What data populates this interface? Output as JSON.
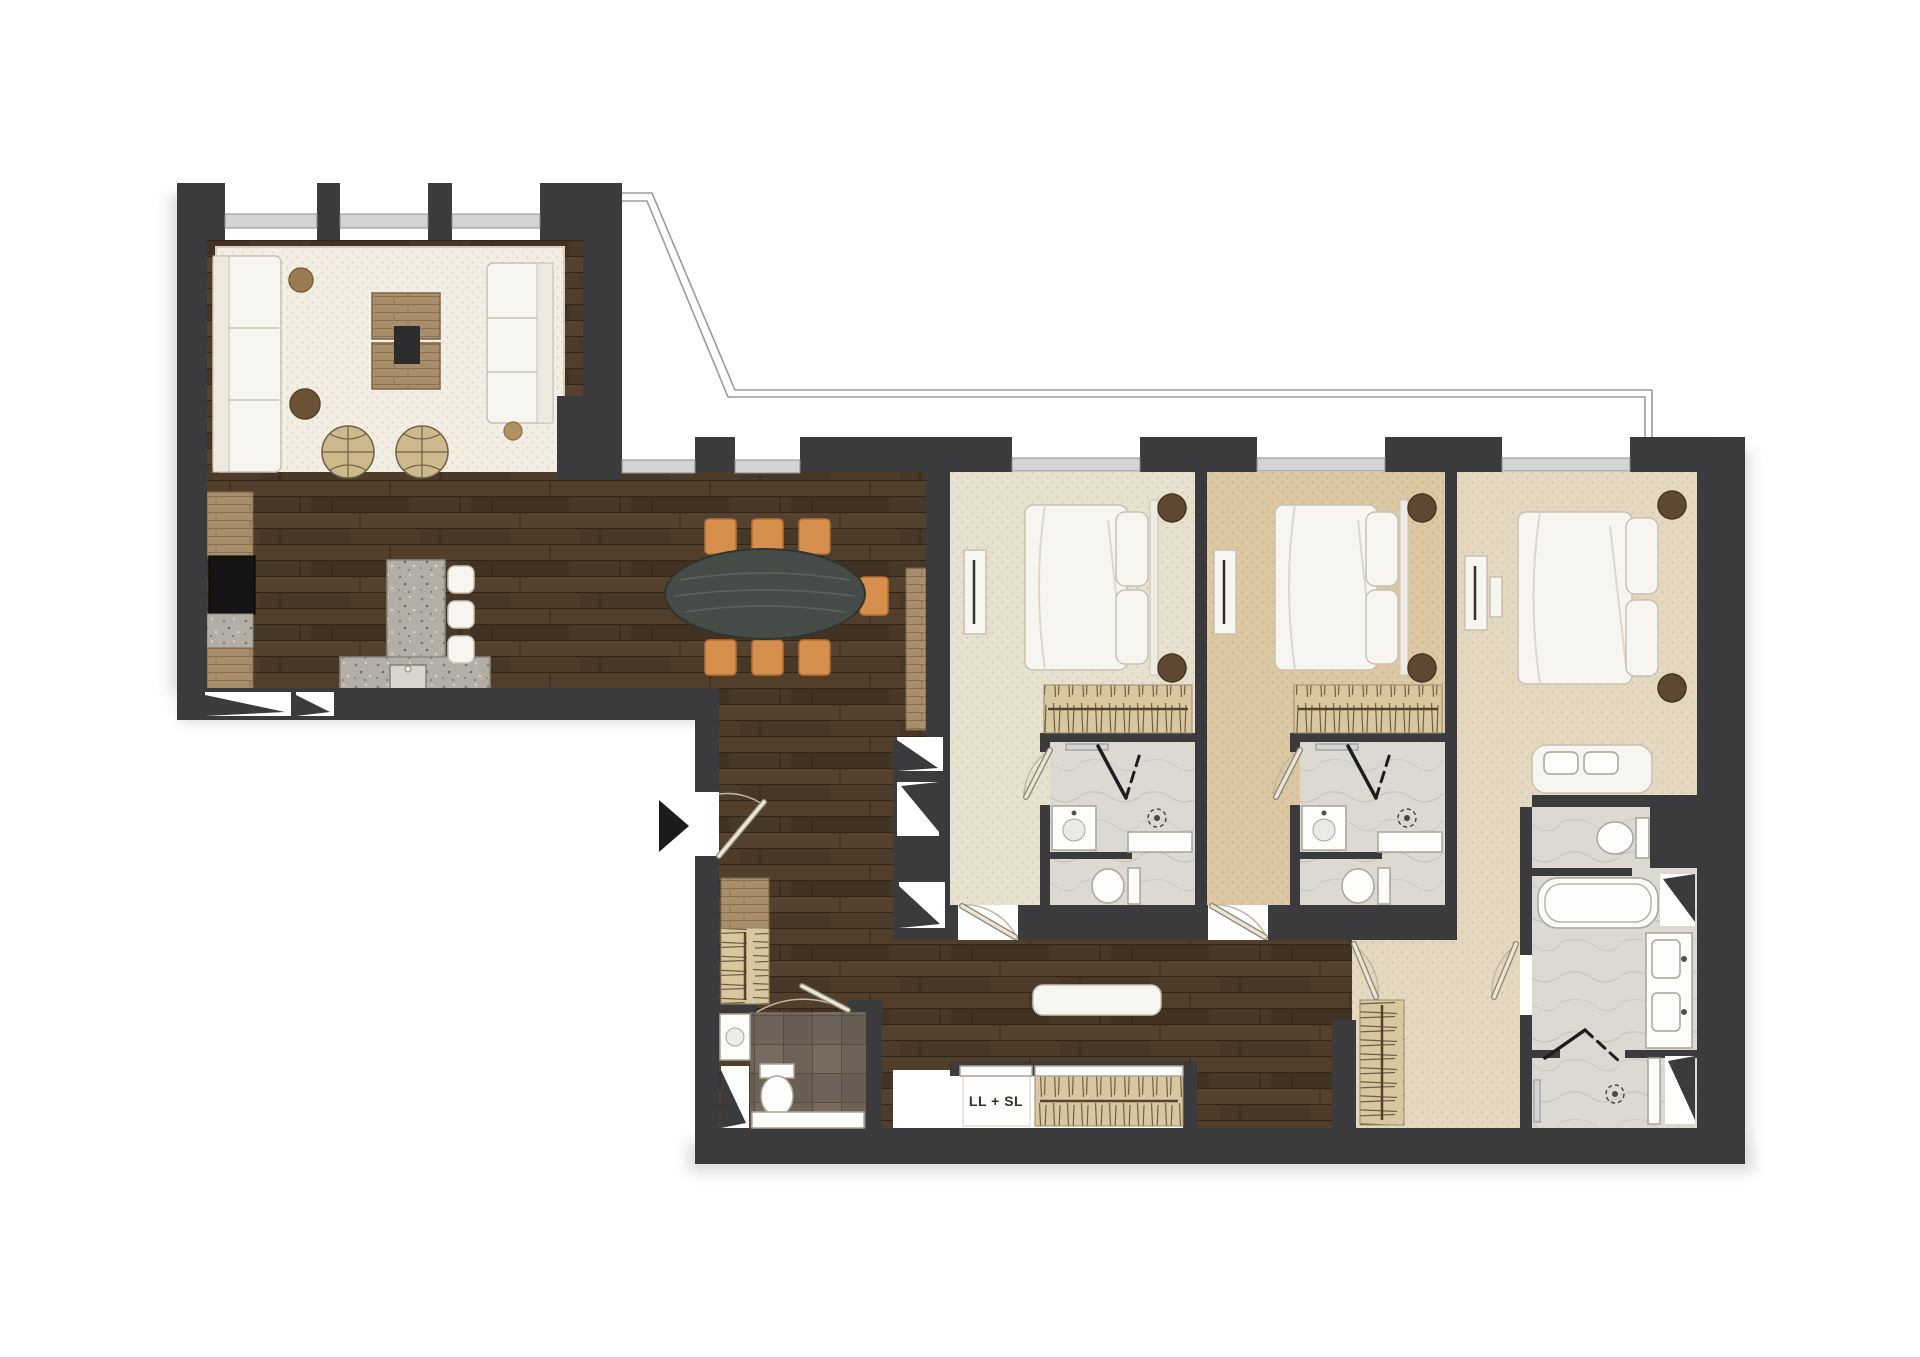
{
  "labels": {
    "laundry": "LL + SL"
  },
  "palette": {
    "wall": "#3b3a3c",
    "wood-base": "#4b3a2a",
    "carpet-cream": "#e9e1d0",
    "carpet-tan": "#dcc8a2",
    "carpet-dressing": "#e4d8c0",
    "rug": "#f2eee3",
    "marble": "#dcd9d3",
    "granite": "#b3afa6",
    "tile-dark": "#6e6359",
    "cabinet-wood": "#a98e6b",
    "closet-stripe": "#d9c7a0",
    "chair-orange": "#d78f4e",
    "table-dark": "#454c48",
    "white-furniture": "#f7f5f0",
    "nightstand-wood": "#5d4832",
    "outline-gray": "#9b9b9b"
  }
}
